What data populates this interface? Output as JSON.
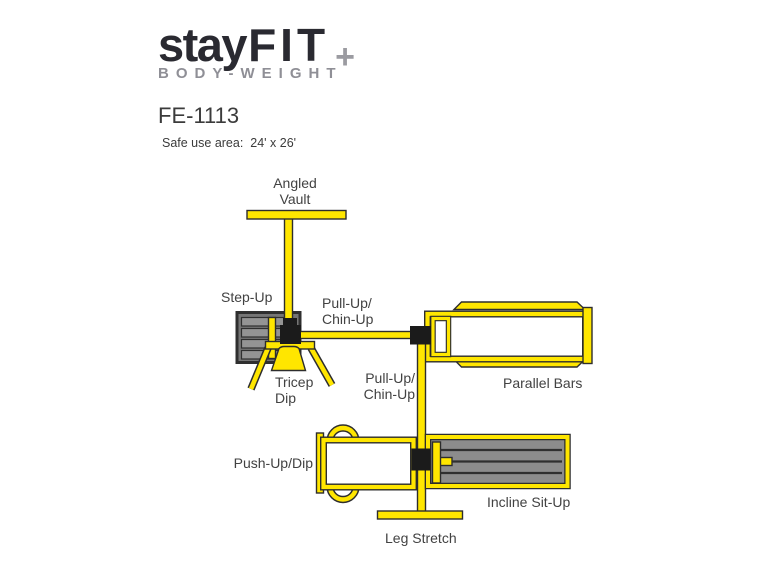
{
  "logo": {
    "brand_stay": "stay",
    "brand_fit": "FIT",
    "brand_plus": "+",
    "tagline": "BODY-WEIGHT",
    "color_dark": "#2a2a31",
    "color_gray": "#8f8f96"
  },
  "header": {
    "model": "FE-1113",
    "safe_use_area": "Safe use area:  24' x 26'"
  },
  "diagram": {
    "type": "equipment-layout-plan",
    "colors": {
      "equipment_yellow": "#ffe600",
      "outline_dark": "#2d2d2d",
      "bench_gray": "#8c8c8c",
      "step_gray": "#757575",
      "junction_black": "#1b1b1b",
      "label_text": "#424242"
    },
    "stations": {
      "angled_vault": {
        "label": "Angled\nVault"
      },
      "step_up": {
        "label": "Step-Up"
      },
      "pull_up_chin_up_top": {
        "label": "Pull-Up/\nChin-Up"
      },
      "parallel_bars": {
        "label": "Parallel Bars"
      },
      "pull_up_chin_up_mid": {
        "label": "Pull-Up/\nChin-Up"
      },
      "tricep_dip": {
        "label": "Tricep\nDip"
      },
      "push_up_dip": {
        "label": "Push-Up/Dip"
      },
      "incline_sit_up": {
        "label": "Incline Sit-Up"
      },
      "leg_stretch": {
        "label": "Leg Stretch"
      }
    }
  }
}
